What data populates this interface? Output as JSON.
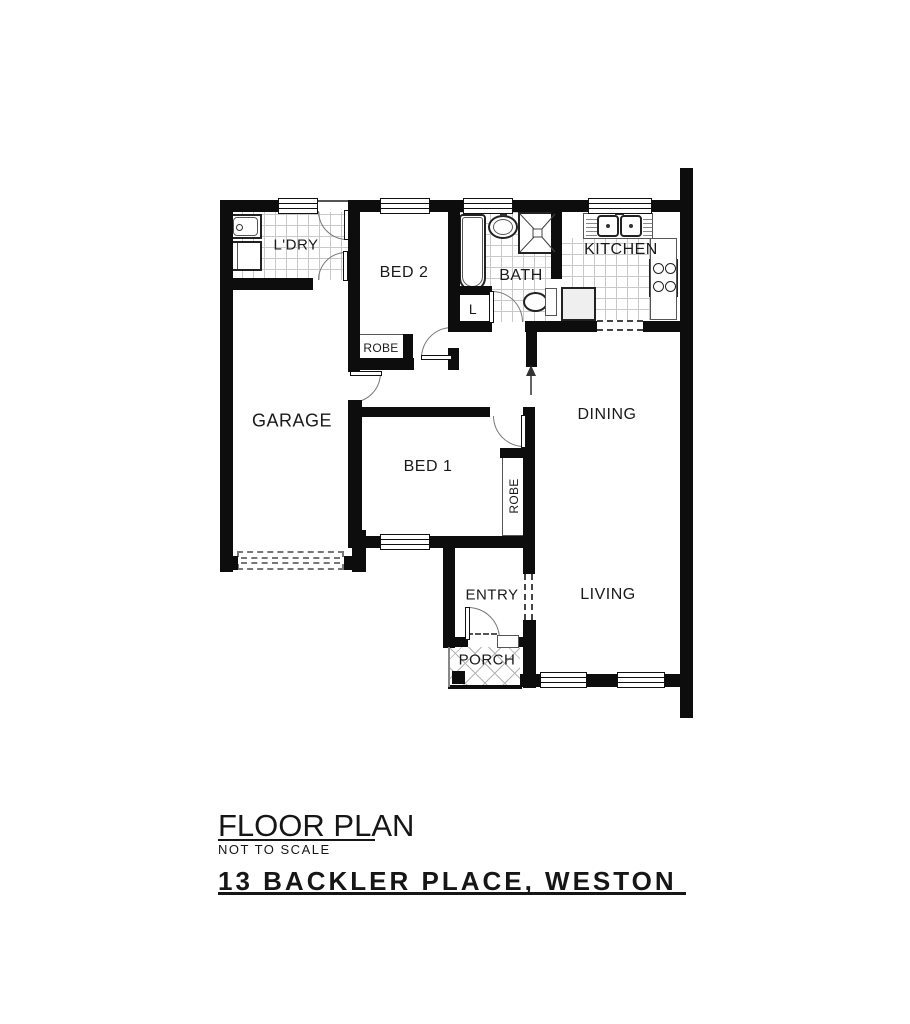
{
  "plan": {
    "rooms": {
      "laundry": "L'DRY",
      "bed2": "BED 2",
      "bath": "BATH",
      "kitchen": "KITCHEN",
      "garage": "GARAGE",
      "bed1": "BED 1",
      "dining": "DINING",
      "living": "LIVING",
      "entry": "ENTRY",
      "porch": "PORCH"
    },
    "closets": {
      "robe_bed2": "ROBE",
      "robe_bed1": "ROBE",
      "linen": "L"
    },
    "colors": {
      "wall": "#0d0d0d",
      "tile_line": "#c9c9c9",
      "text": "#1a1a1a"
    }
  },
  "footer": {
    "title": "FLOOR PLAN",
    "subtitle": "NOT TO SCALE",
    "address": "13 BACKLER PLACE, WESTON"
  }
}
